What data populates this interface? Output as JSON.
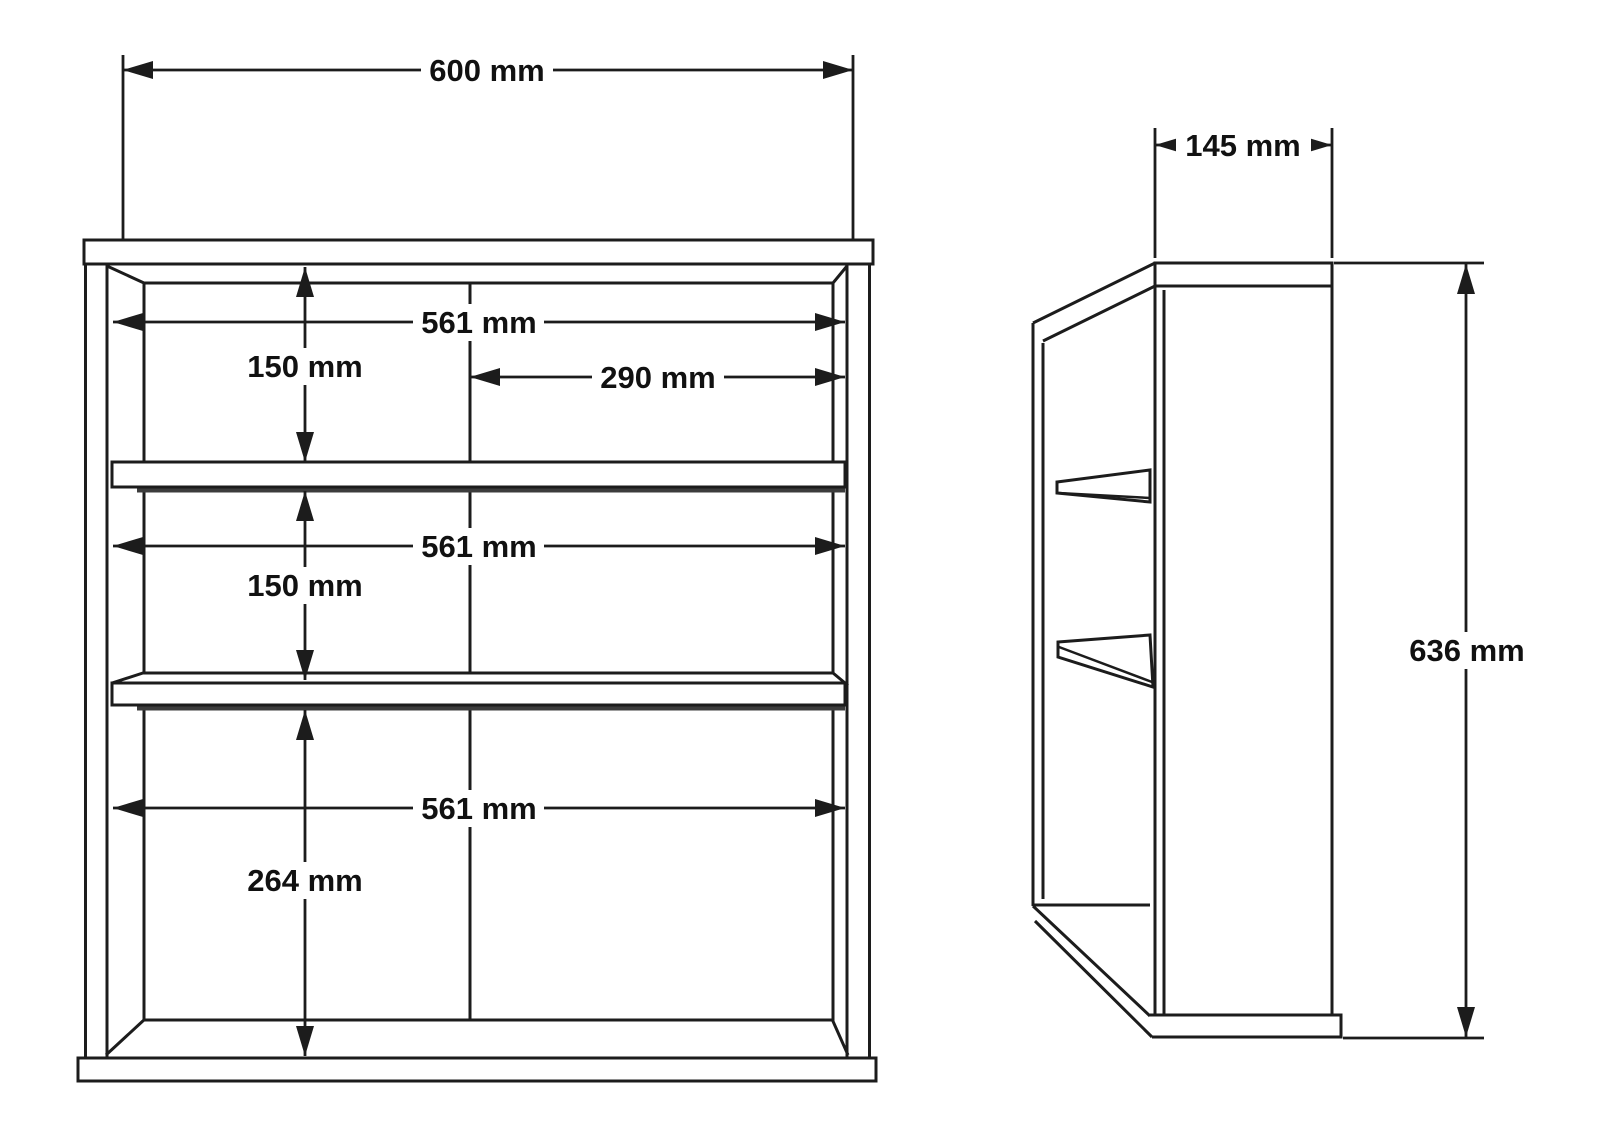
{
  "page": {
    "background": "#ffffff"
  },
  "drawing": {
    "type": "furniture-technical-drawing",
    "line_color": "#1c1c1c",
    "shadow_color": "#3c3c3c",
    "front_view": {
      "dim_overall_width": "600 mm",
      "dim_inner_width_top": "561 mm",
      "dim_inner_width_middle": "561 mm",
      "dim_inner_width_bottom": "561 mm",
      "dim_right_half_width": "290 mm",
      "dim_top_section_height": "150 mm",
      "dim_middle_section_height": "150 mm",
      "dim_bottom_section_height": "264 mm"
    },
    "side_view": {
      "dim_depth": "145 mm",
      "dim_height": "636 mm"
    }
  }
}
